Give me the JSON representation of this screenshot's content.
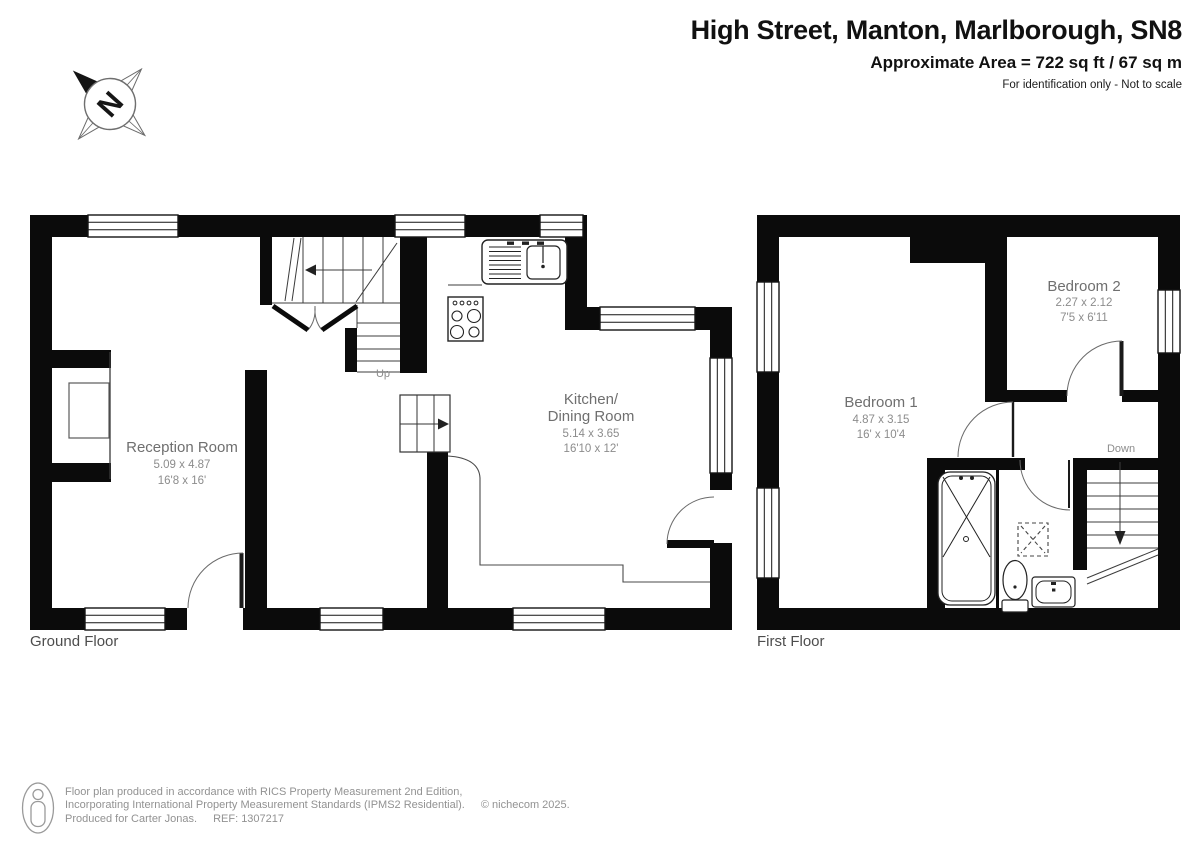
{
  "header": {
    "title": "High Street, Manton, Marlborough, SN8",
    "area": "Approximate Area = 722 sq ft / 67 sq m",
    "disclaimer": "For identification only - Not to scale"
  },
  "compass": {
    "north_letter": "N"
  },
  "floors": {
    "ground": {
      "label": "Ground Floor",
      "stairs_label": "Up",
      "rooms": [
        {
          "name": "Reception Room",
          "metric": "5.09 x 4.87",
          "imperial": "16'8 x 16'"
        },
        {
          "name_line1": "Kitchen/",
          "name_line2": "Dining Room",
          "metric": "5.14 x 3.65",
          "imperial": "16'10 x 12'"
        }
      ]
    },
    "first": {
      "label": "First Floor",
      "stairs_label": "Down",
      "rooms": [
        {
          "name": "Bedroom 1",
          "metric": "4.87 x 3.15",
          "imperial": "16' x 10'4"
        },
        {
          "name": "Bedroom 2",
          "metric": "2.27 x 2.12",
          "imperial": "7'5 x 6'11"
        }
      ]
    }
  },
  "footer": {
    "line1": "Floor plan produced in accordance with RICS Property Measurement 2nd Edition,",
    "line2": "Incorporating International Property Measurement Standards (IPMS2 Residential).",
    "copyright": "© nichecom 2025.",
    "produced": "Produced for Carter Jonas.",
    "ref": "REF: 1307217"
  }
}
